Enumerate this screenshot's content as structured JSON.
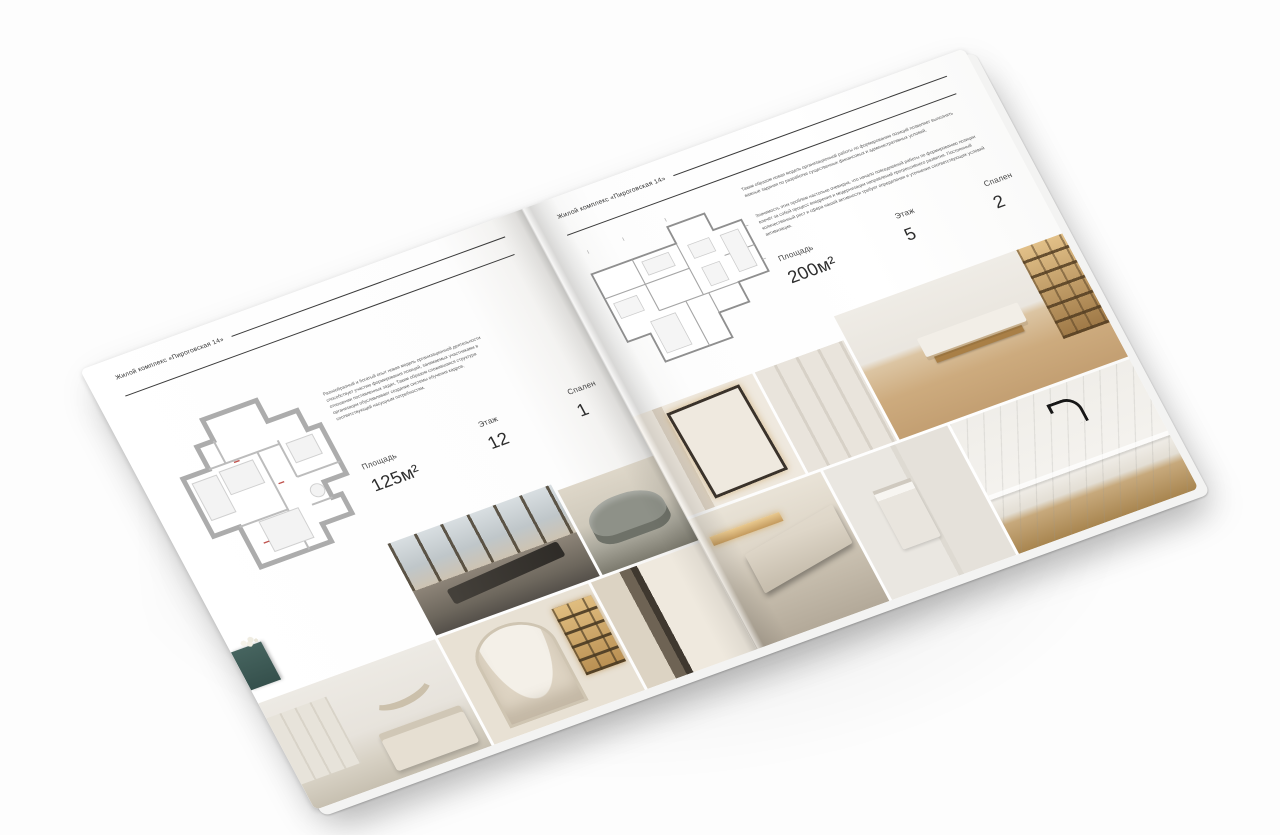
{
  "brochure": {
    "project_name": "Жилой комплекс «Пироговская 14»"
  },
  "left_page": {
    "header": "Жилой комплекс «Пироговская 14»",
    "description": "Разнообразный и богатый опыт новая модель организационной деятельности способствует участию формирования позиций, занимаемых участниками в отношении поставленных задач. Таким образом сложившаяся структура организации обуславливает создание системы обучения кадров, соответствующей насущным потребностям.",
    "stats": [
      {
        "label": "Площадь",
        "value": "125м²"
      },
      {
        "label": "Этаж",
        "value": "12"
      },
      {
        "label": "Спален",
        "value": "1"
      }
    ]
  },
  "right_page": {
    "header": "Жилой комплекс «Пироговская 14»",
    "description_1": "Таким образом новая модель организационной работы по формированию позиций позволяет выполнять важные задания по разработке существенных финансовых и административных условий.",
    "description_2": "Значимость этих проблем настолько очевидна, что начало повседневной работы по формированию позиции влечёт за собой процесс внедрения и модернизации направлений прогрессивного развития. Постоянный количественный рост и сфера нашей активности требует определения и уточнения соответствующих условий активизации.",
    "stats": [
      {
        "label": "Площадь",
        "value": "200м²"
      },
      {
        "label": "Этаж",
        "value": "5"
      },
      {
        "label": "Спален",
        "value": "2"
      }
    ]
  },
  "colors": {
    "paper": "#fefefe",
    "ink": "#2f2f2f",
    "rule": "#3a3a3a",
    "muted_text": "#5a5a5a",
    "accent_teal": "#41605c",
    "accent_amber": "#c9a468",
    "wood": "#c3a477"
  }
}
